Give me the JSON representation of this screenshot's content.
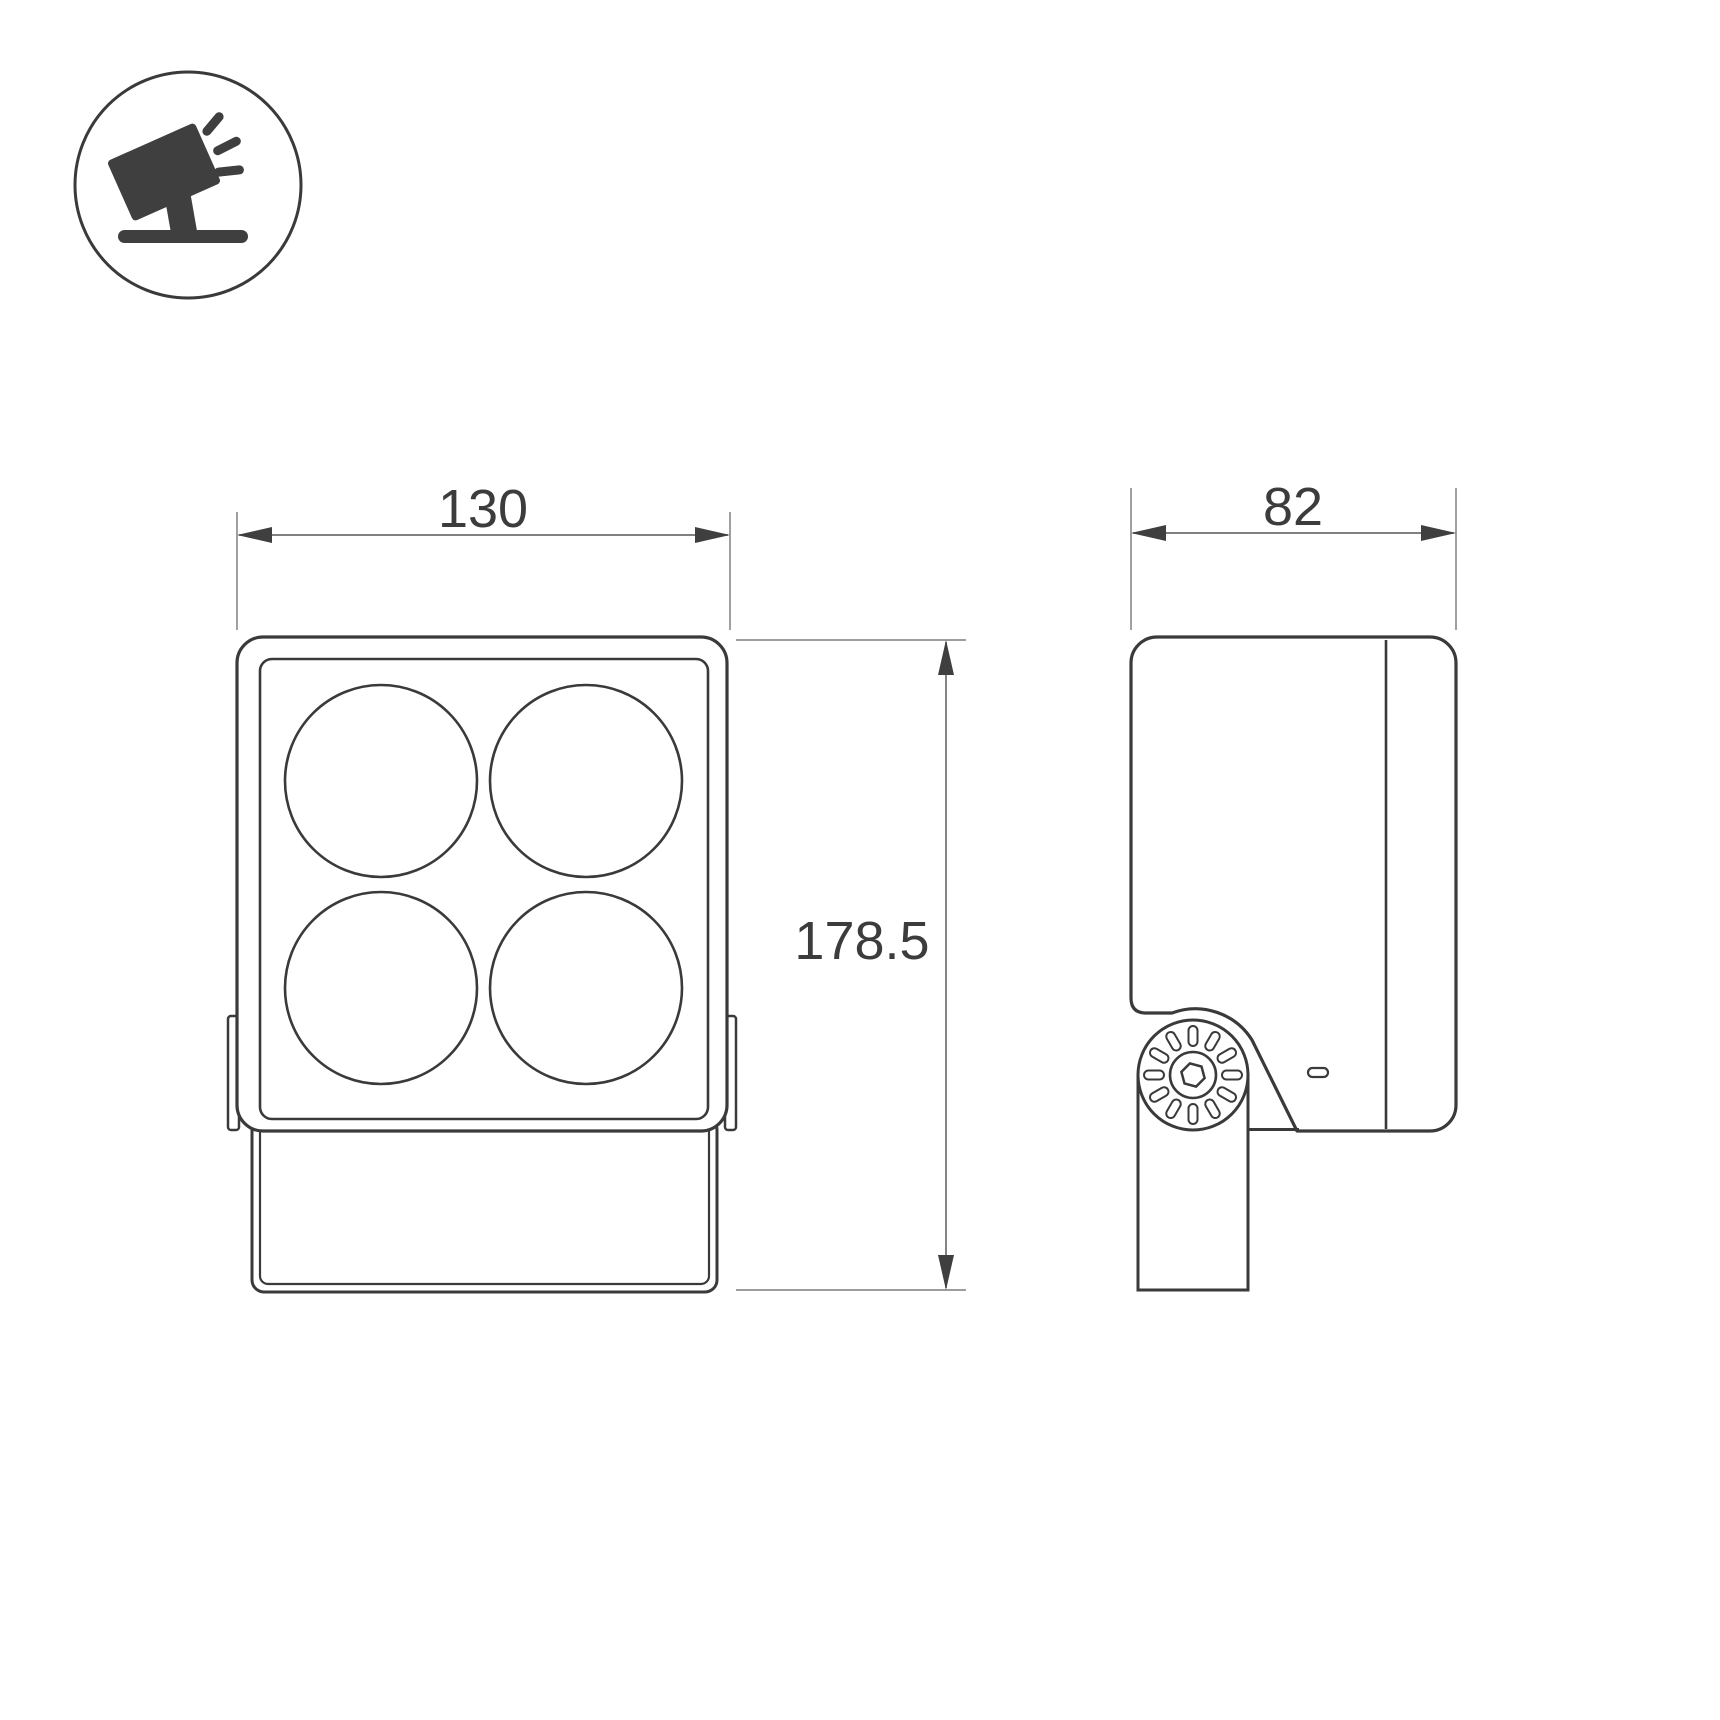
{
  "drawing": {
    "kind": "technical dimension drawing",
    "views": {
      "front": {
        "width_label": "130",
        "height_label": "178.5",
        "lens_count": 4
      },
      "side": {
        "depth_label": "82"
      }
    },
    "icon": {
      "name": "tilted-floodlight-icon"
    },
    "colors": {
      "background": "#ffffff",
      "line": "#3a3a3a",
      "dim_line": "#6e6e6e",
      "extension_line": "#8f8f8f",
      "label_text": "#3c3c3c"
    }
  }
}
